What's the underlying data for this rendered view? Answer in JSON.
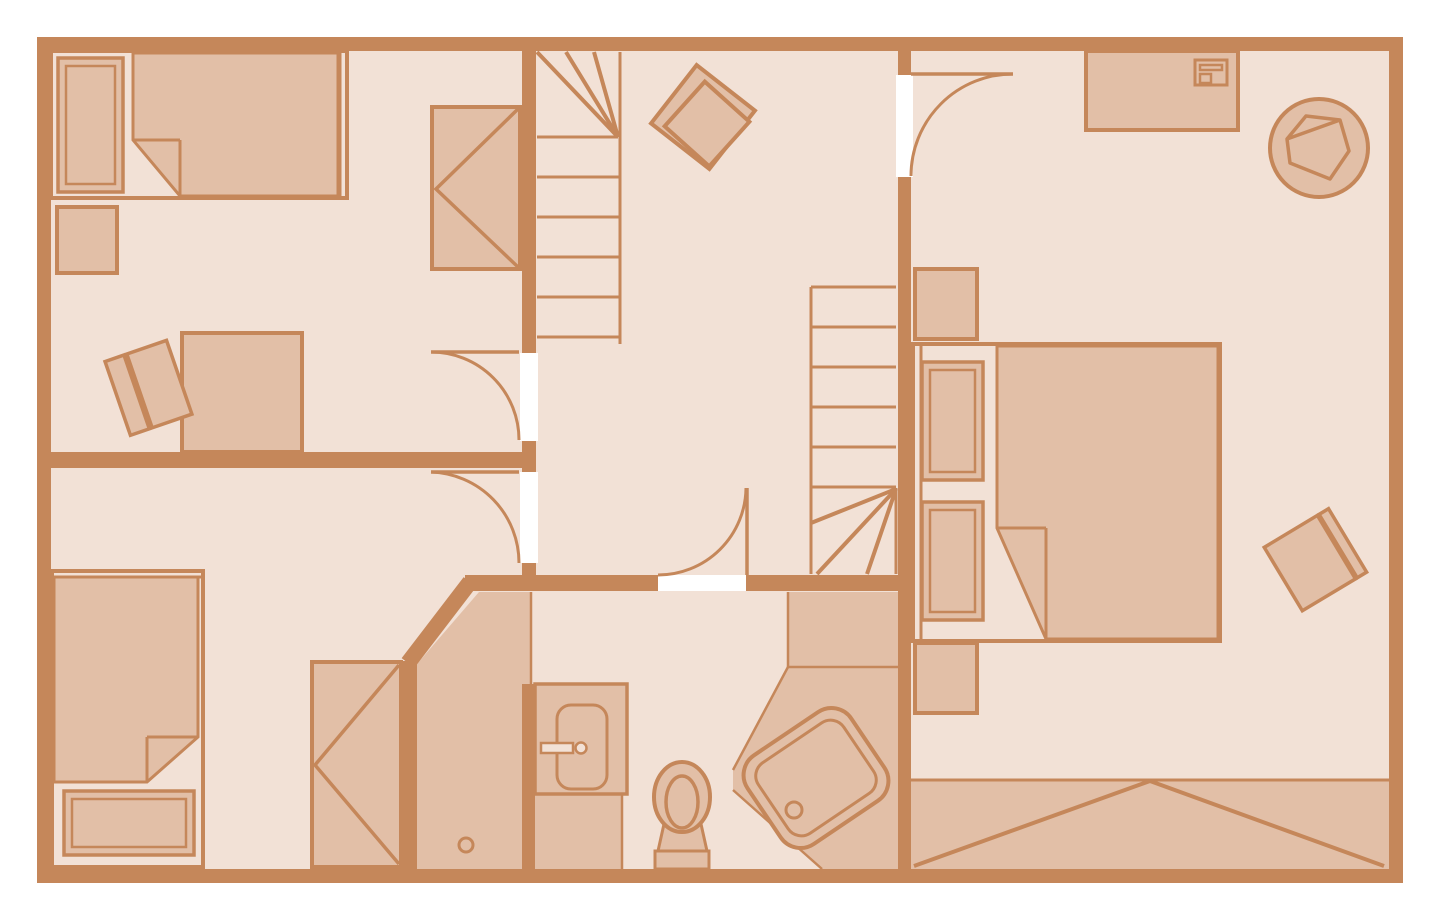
{
  "document": {
    "kind": "architectural-floor-plan",
    "storey": "upper floor with sloped-ceiling zone",
    "visible_text": []
  },
  "colors": {
    "page_background": "#ffffff",
    "wall_and_lines": "#c5875a",
    "floor_light": "#f2e1d6",
    "furniture_and_dark_floor": "#e2bfa7",
    "door_opening": "#ffffff"
  },
  "rooms": [
    {
      "id": "bedroom-top-left",
      "furniture": [
        "single-bed-with-pillow-and-folded-blanket",
        "nightstand",
        "desk",
        "desk-chair",
        "wardrobe"
      ]
    },
    {
      "id": "bedroom-bottom-left",
      "furniture": [
        "single-bed-with-pillow-and-folded-blanket",
        "wardrobe"
      ]
    },
    {
      "id": "hall-landing",
      "furniture": [
        "armchair"
      ],
      "features": [
        "upper-stair-flight-with-winders",
        "lower-stair-flight-with-winders",
        "door-to-bedroom-top-left",
        "door-to-bedroom-bottom-left",
        "door-to-bedroom-right",
        "door-to-bathroom"
      ]
    },
    {
      "id": "bathroom",
      "furniture": [
        "sink-vanity-with-faucet",
        "toilet",
        "corner-bathtub-rotated",
        "shower-strip-with-floor-drain"
      ],
      "features": [
        "angled-wall"
      ]
    },
    {
      "id": "bedroom-right",
      "furniture": [
        "double-bed-with-two-pillows-and-folded-blanket",
        "nightstand-upper",
        "nightstand-lower",
        "desk",
        "laptop",
        "round-swivel-chair",
        "side-chair"
      ],
      "features": [
        "sloped-ceiling-attic-band-with-gable-lines"
      ]
    }
  ]
}
